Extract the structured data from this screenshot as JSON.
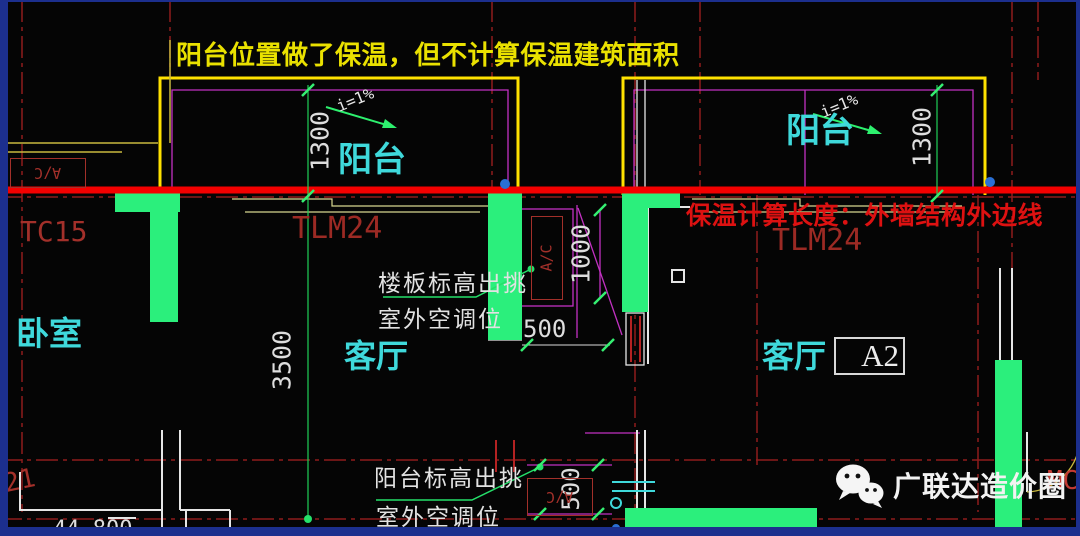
{
  "annotations": {
    "top_note": "阳台位置做了保温，但不计算保温建筑面积",
    "insulation_note": "保温计算长度：外墙结构外边线"
  },
  "rooms": {
    "balcony_left": "阳台",
    "balcony_right": "阳台",
    "bedroom": "卧室",
    "living_left": "客厅",
    "living_right": "客厅"
  },
  "unit_label": "A2",
  "dims": {
    "balcony_left_depth": "1300",
    "balcony_right_depth": "1300",
    "living_depth": "3500",
    "ac_recess_depth": "1000",
    "ac_recess_width": "500",
    "ac_platform_depth": "500"
  },
  "level": "44.800",
  "slope": {
    "left": "i=1%",
    "right": "i=1%"
  },
  "tags": {
    "window_left": "TC15",
    "door_left": "TLM24",
    "door_right": "TLM24",
    "grid_partial": "21",
    "edge_partial": "MC",
    "ac": "A/C"
  },
  "leaders": {
    "floor_ac_line1": "楼板标高出挑",
    "floor_ac_line2": "室外空调位",
    "balcony_ac_line1": "阳台标高出挑",
    "balcony_ac_line2": "室外空调位"
  },
  "watermark": {
    "brand": "广联达造价圈"
  },
  "colors": {
    "highlight_line": "#f40000",
    "note_yellow": "#eae100",
    "note_red": "#dd1111",
    "wall_fill_green": "#2bef7c",
    "room_label_cyan": "#3fd9db",
    "cad_line_red": "#8f1d1d",
    "cad_magenta": "#c231c2",
    "balcony_yellow": "#ffe100",
    "dim_text": "#dedede",
    "frame_blue": "#1c2f8e"
  }
}
